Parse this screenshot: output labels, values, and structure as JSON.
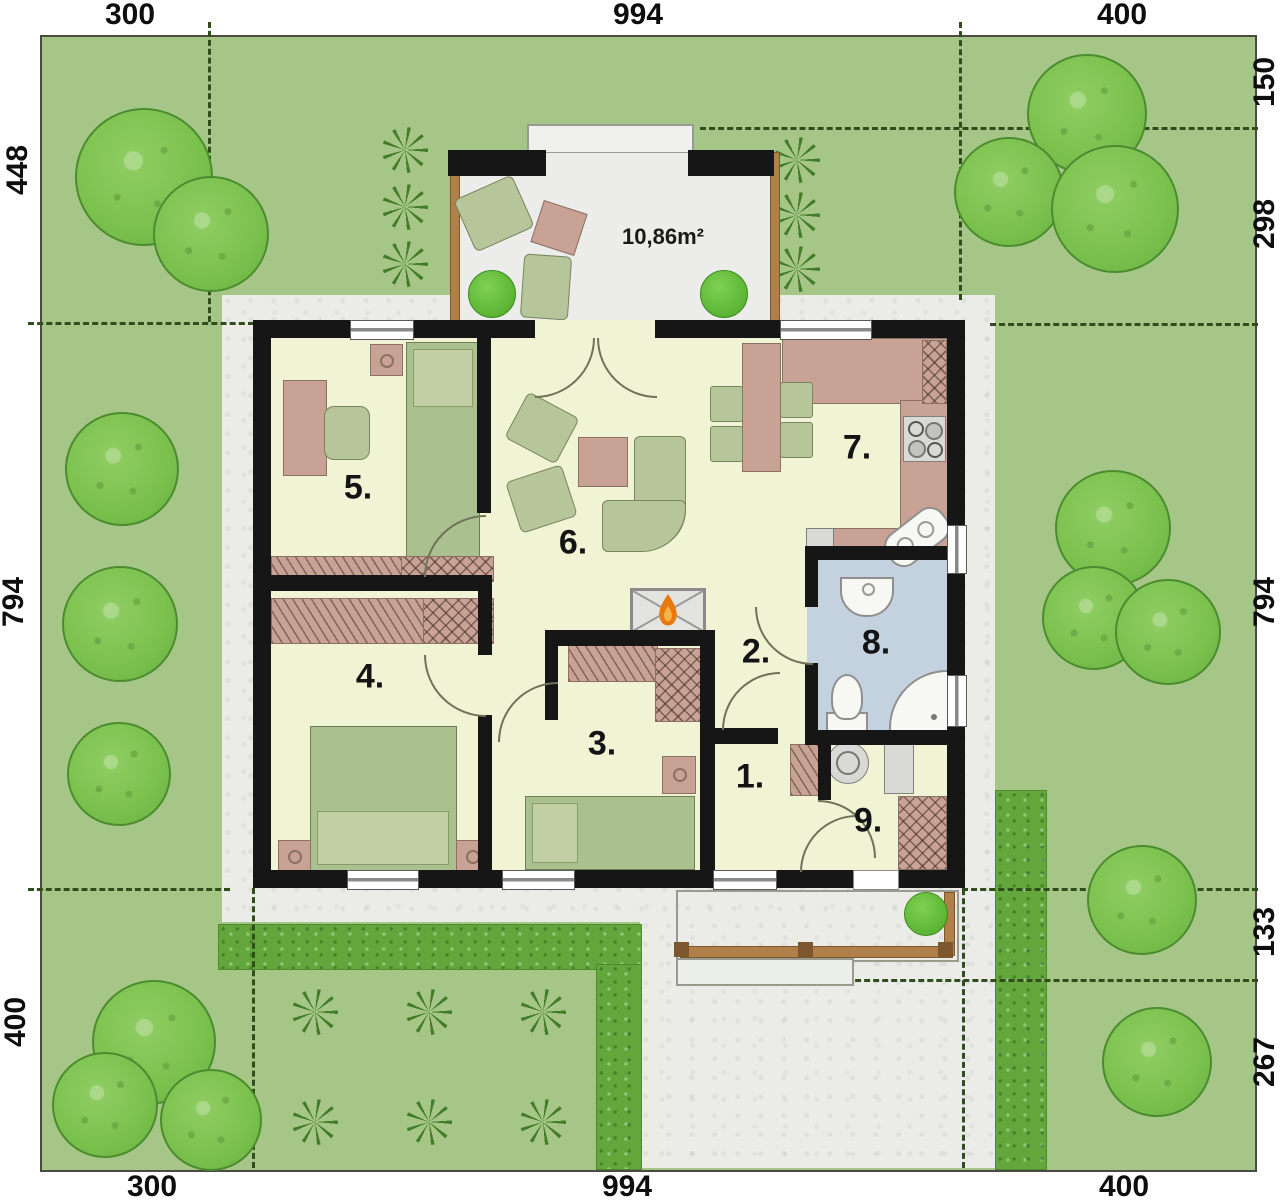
{
  "plan": {
    "terrace_area": "10,86m²",
    "rooms": [
      {
        "number": "1."
      },
      {
        "number": "2."
      },
      {
        "number": "3."
      },
      {
        "number": "4."
      },
      {
        "number": "5."
      },
      {
        "number": "6."
      },
      {
        "number": "7."
      },
      {
        "number": "8."
      },
      {
        "number": "9."
      }
    ],
    "dimensions": {
      "top": [
        "300",
        "994",
        "400"
      ],
      "bottom": [
        "300",
        "994",
        "400"
      ],
      "left": [
        "448",
        "794",
        "400"
      ],
      "right": [
        "150",
        "298",
        "794",
        "133",
        "267"
      ]
    }
  },
  "colors": {
    "lawn": "#a6c687",
    "paving": "#ebece7",
    "hedge": "#63a73c",
    "tree": "#7cc24f",
    "wall": "#161616",
    "floor": "#f0f4d5",
    "bath_floor": "#c4d1df",
    "furniture_pink": "#c8a295",
    "furniture_green": "#b7c59a",
    "flame": "#e8790f"
  }
}
